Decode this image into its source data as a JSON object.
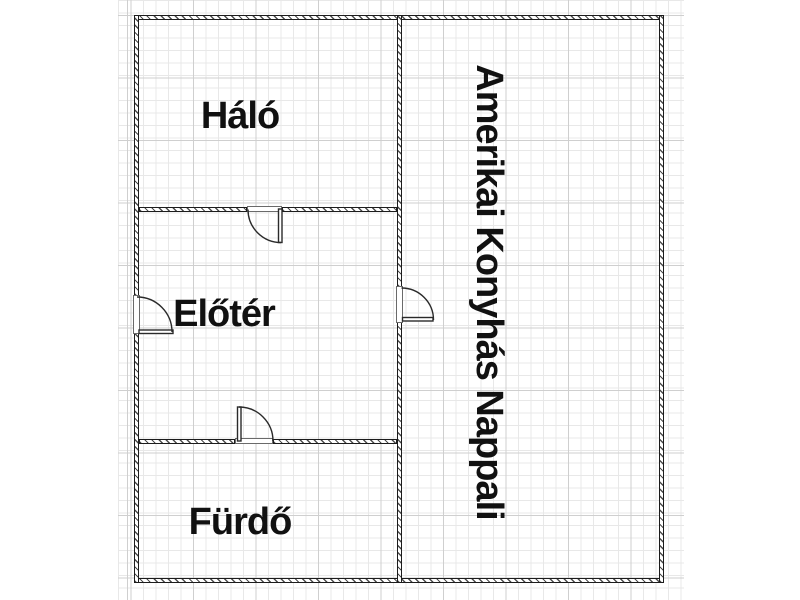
{
  "floor_plan": {
    "rooms": [
      {
        "id": "halo",
        "label": "Háló"
      },
      {
        "id": "eloter",
        "label": "Előtér"
      },
      {
        "id": "furdo",
        "label": "Fürdő"
      },
      {
        "id": "nappali",
        "label": "Amerikai Konyhás Nappali"
      }
    ],
    "symbols": [
      "entrance-door-swing",
      "halo-door-swing",
      "nappali-door-swing",
      "furdo-door-swing"
    ],
    "colors": {
      "wall": "#1c1c1c",
      "door_line": "#2a2a2a",
      "grid_minor": "#e8e8e8",
      "grid_major": "#cfcfcf",
      "label_text": "#111111",
      "background": "#ffffff"
    }
  }
}
